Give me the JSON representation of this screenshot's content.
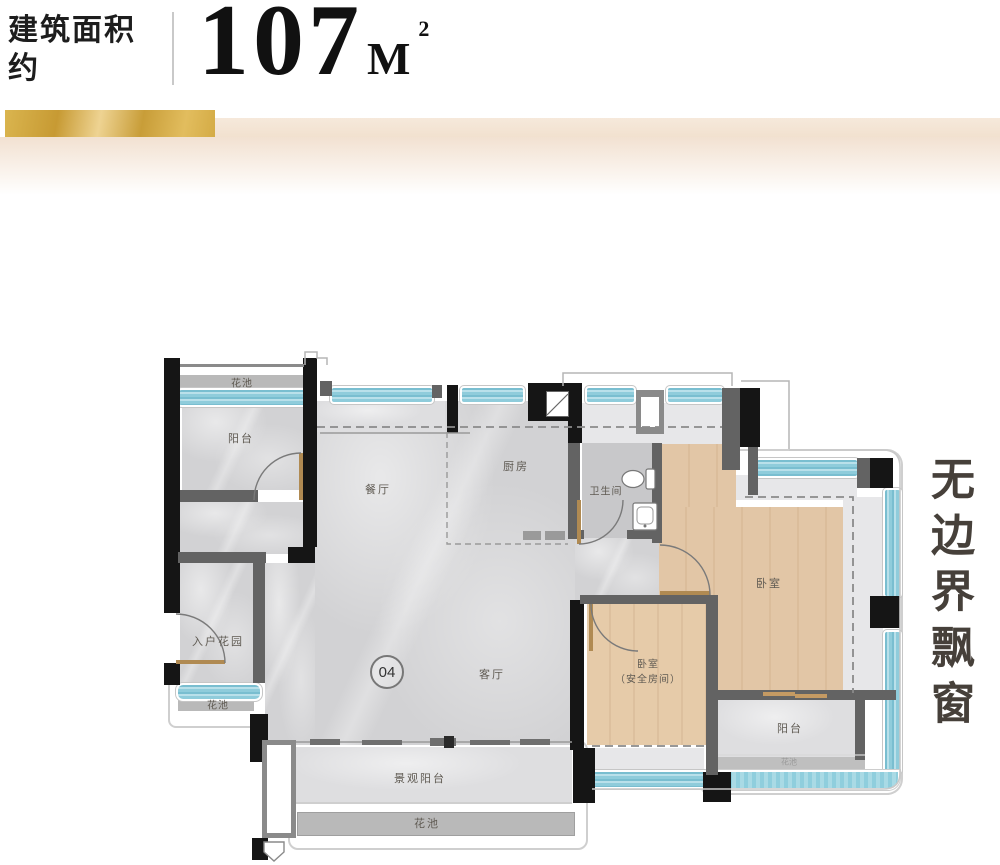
{
  "header": {
    "area_label_line1": "建筑面积",
    "area_label_line2": "约",
    "area_value": "107",
    "area_unit": "M",
    "area_sup": "2"
  },
  "side_note": "无边界飘窗",
  "plan": {
    "unit_number": "04",
    "labels": {
      "flower_bed_top": "花池",
      "balcony_top_left": "阳台",
      "dining": "餐厅",
      "kitchen": "厨房",
      "bathroom": "卫生间",
      "entry_garden": "入户花园",
      "flower_bed_left": "花池",
      "living": "客厅",
      "bedroom_master": "卧室",
      "bedroom_safe_line1": "卧室",
      "bedroom_safe_line2": "（安全房间）",
      "scenic_balcony": "景观阳台",
      "flower_bed_bottom": "花池",
      "balcony_bottom_right": "阳台",
      "flower_bed_right": "花池"
    }
  },
  "colors": {
    "gold": "#c79a33",
    "window_blue": "#8ccbdb",
    "wood_floor": "#e2c6a6",
    "marble_floor": "#d2d2d4",
    "wall_black": "#151515",
    "wall_gray": "#636363"
  }
}
